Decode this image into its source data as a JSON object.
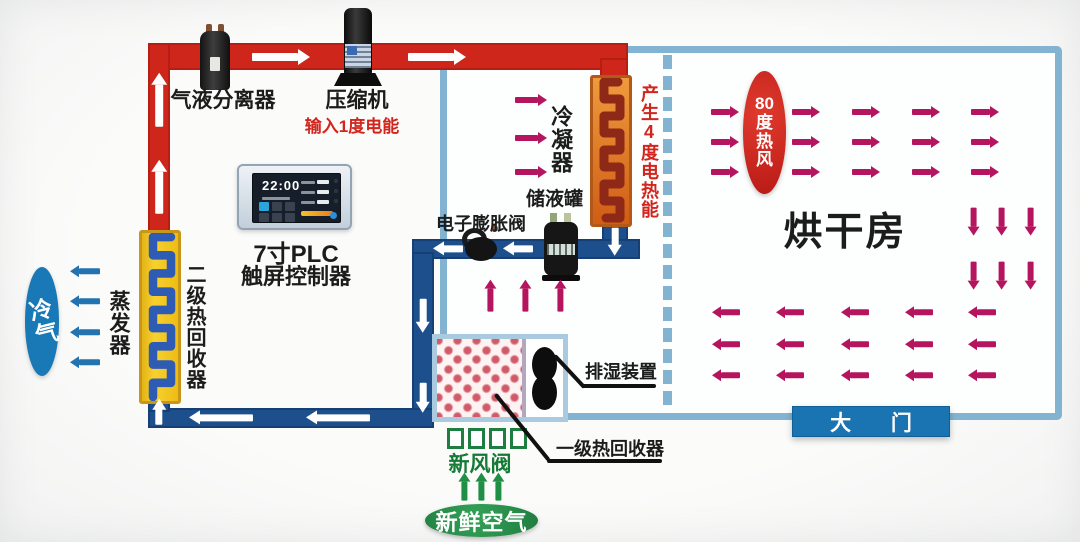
{
  "top_section": {
    "separator_label": "气液分离器",
    "compressor_label": "压缩机",
    "compressor_input_label": "输入1度电能"
  },
  "plc": {
    "time": "22:00",
    "label_line1": "7寸PLC",
    "label_line2": "触屏控制器"
  },
  "machine_room": {
    "condenser_label": "冷凝器",
    "heat_output_label": "产生4度电热能",
    "tank_label": "储液罐",
    "expansion_valve_label": "电子膨胀阀",
    "dehumidifier_label": "排湿装置",
    "heat_recovery1_label": "一级热回收器"
  },
  "left_section": {
    "cold_air_label": "冷气",
    "evaporator_label": "蒸发器",
    "heat_recovery2_label": "二级热回收器"
  },
  "fresh_air_section": {
    "valve_label": "新风阀",
    "air_label": "新鲜空气"
  },
  "drying_room": {
    "room_label": "烘干房",
    "hot_wind_value": "80",
    "hot_wind_char1": "度",
    "hot_wind_char2": "热",
    "hot_wind_char3": "风",
    "door_label": "大 门"
  },
  "colors": {
    "hot_pipe": "#cf261b",
    "cold_pipe": "#1d4f8c",
    "wall": "#82b4d2",
    "magenta_arrow": "#b5155e",
    "blue_arrow": "#2273af",
    "green_arrow": "#1e8f44",
    "white_arrow": "#ffffff",
    "red_text": "#d2251d",
    "green_text": "#157a35",
    "door_fill": "#1b74b2",
    "cold_ellipse": "#1879b6",
    "hot_ellipse": "#cc2322",
    "fresh_ellipse": "#2a9648"
  }
}
